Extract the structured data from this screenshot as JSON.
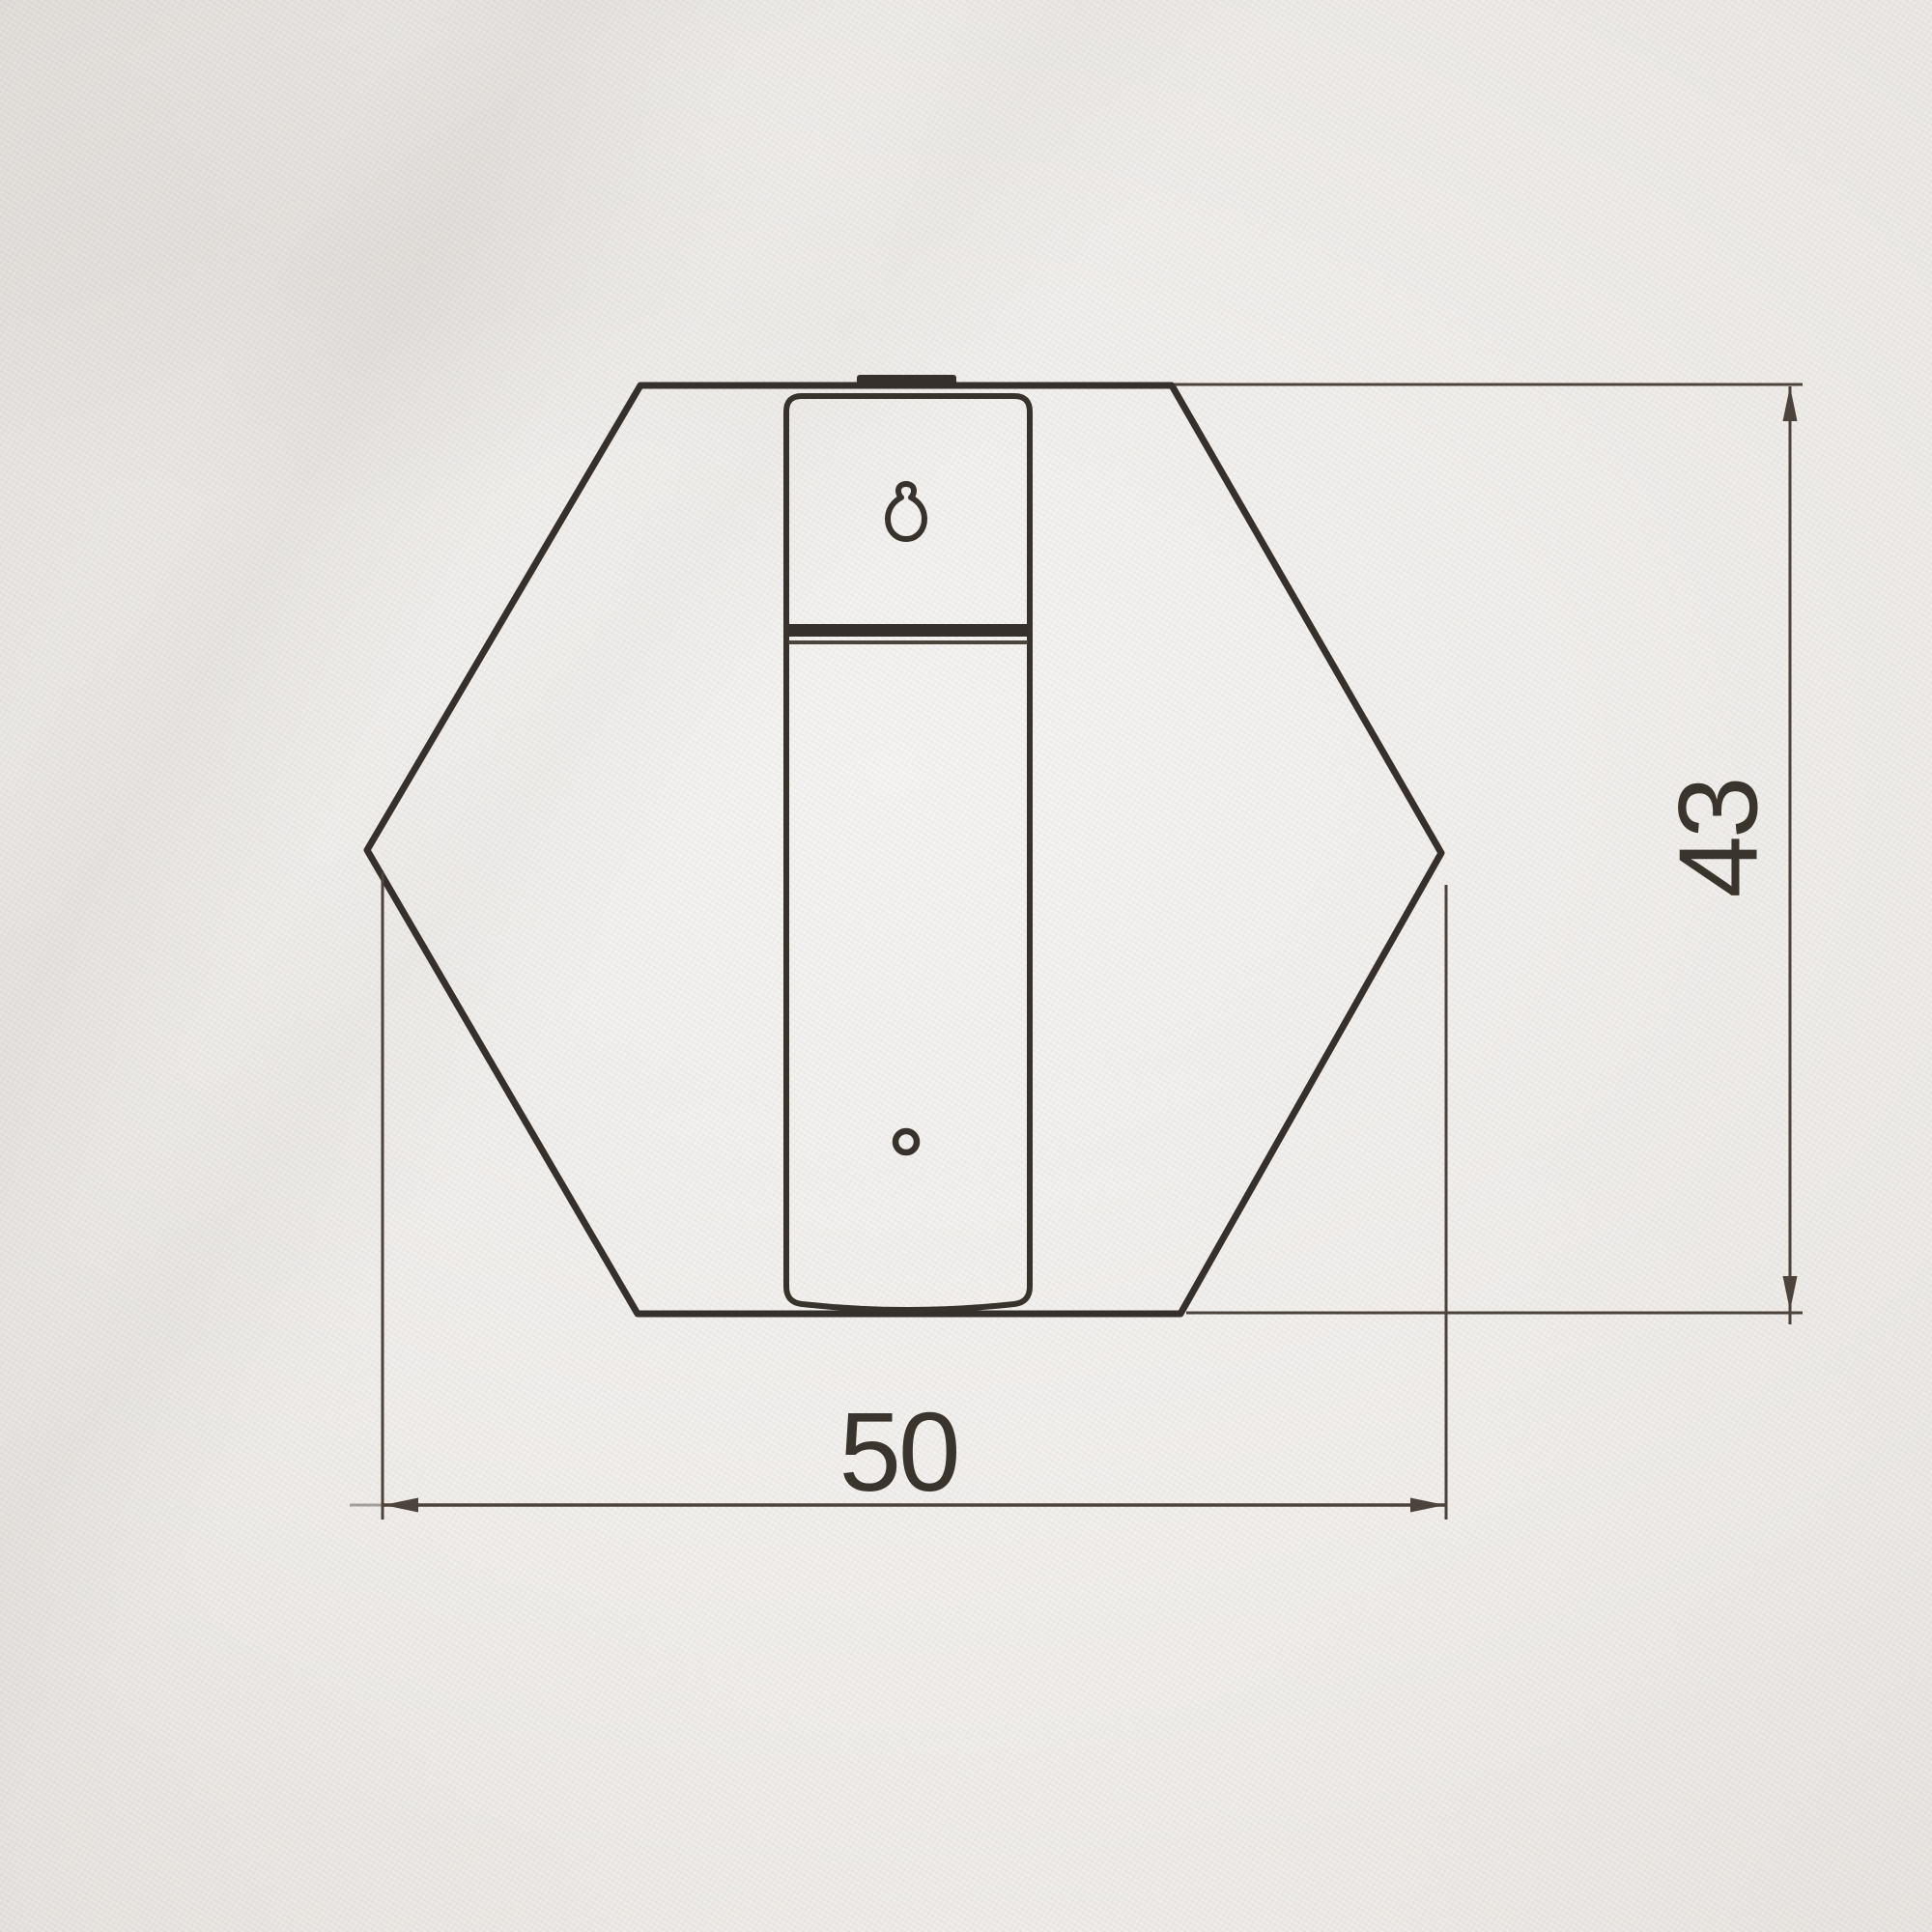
{
  "drawing": {
    "kind": "technical-dimension-drawing",
    "view": "front-view-hexagonal-knob-with-mounting-strip",
    "dimensions": {
      "width": "50",
      "height": "43"
    },
    "colors": {
      "outline": "#35302b",
      "dimension_line": "#4c433c",
      "label_text": "#3a342e",
      "paper": "#e9e6e3"
    },
    "icons": {
      "keyhole_hole": "keyhole-hole",
      "screw_hole": "screw-hole"
    }
  }
}
